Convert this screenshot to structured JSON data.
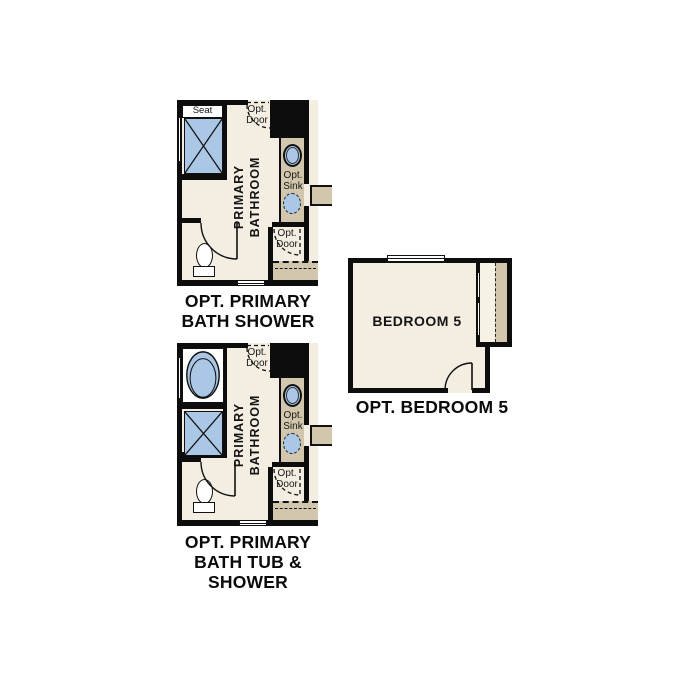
{
  "colors": {
    "background": "#ffffff",
    "floor": "#f3eee1",
    "counter_tan": "#d2c6ad",
    "fixture_blue": "#aac8e6",
    "wall_black": "#0d0d0d",
    "text": "#0b0b0b"
  },
  "labels": {
    "opt": "Opt.",
    "door": "Door",
    "sink": "Sink",
    "seat": "Seat"
  },
  "plans": {
    "bath_shower": {
      "room_line1": "PRIMARY",
      "room_line2": "BATHROOM",
      "caption_line1": "OPT. PRIMARY",
      "caption_line2": "BATH SHOWER"
    },
    "bath_tub_shower": {
      "room_line1": "PRIMARY",
      "room_line2": "BATHROOM",
      "caption_line1": "OPT. PRIMARY",
      "caption_line2": "BATH TUB &",
      "caption_line3": "SHOWER"
    },
    "bedroom5": {
      "room_label": "BEDROOM 5",
      "caption": "OPT. BEDROOM 5"
    }
  }
}
